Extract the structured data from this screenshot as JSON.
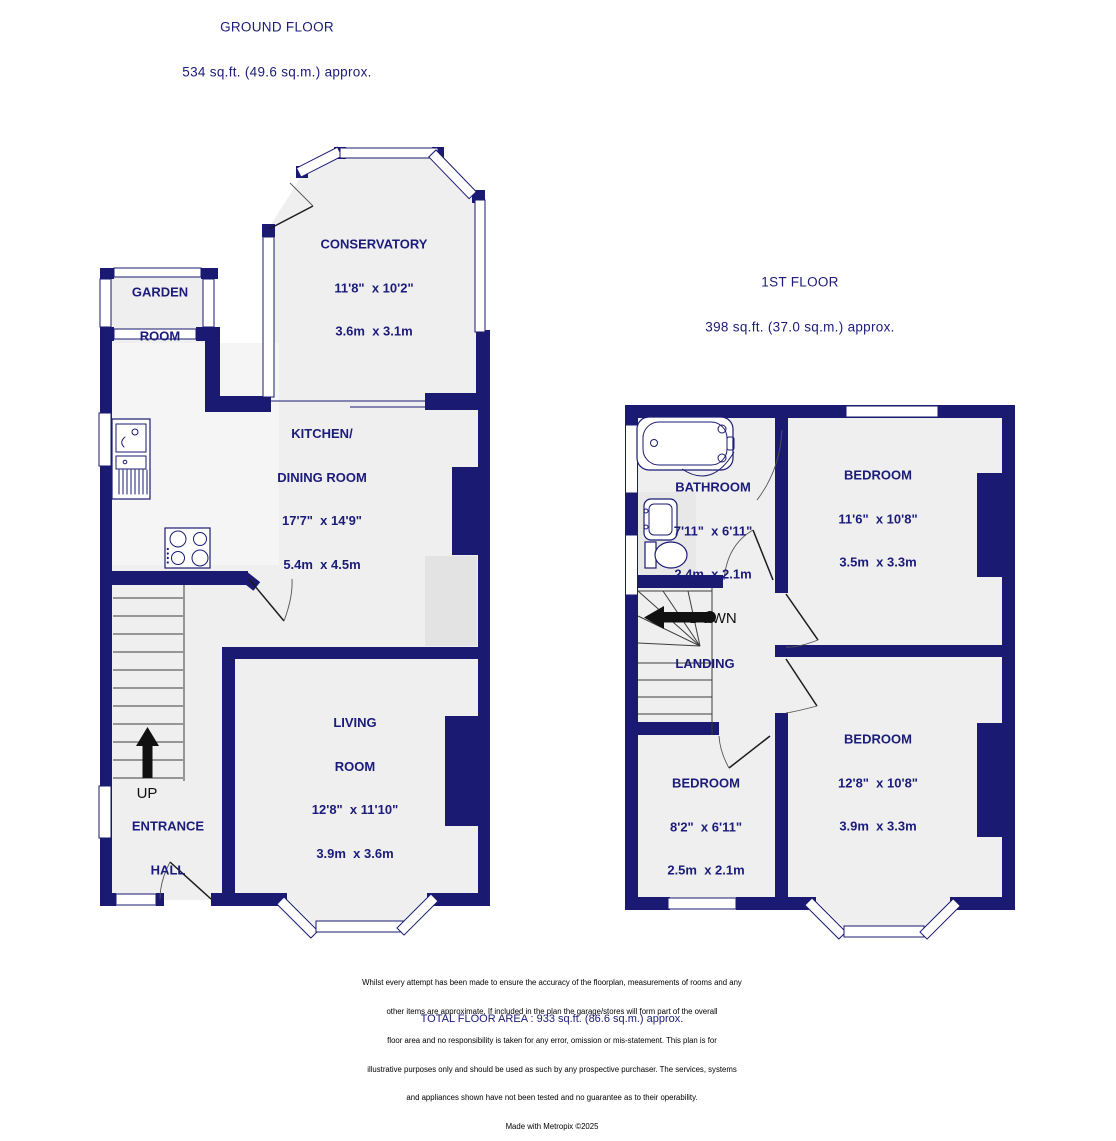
{
  "ground_title": {
    "name": "GROUND FLOOR",
    "area": "534 sq.ft. (49.6 sq.m.) approx."
  },
  "first_title": {
    "name": "1ST FLOOR",
    "area": "398 sq.ft. (37.0 sq.m.) approx."
  },
  "rooms": {
    "conservatory": {
      "name": "CONSERVATORY",
      "imperial": "11'8\"  x 10'2\"",
      "metric": "3.6m  x 3.1m"
    },
    "garden_room": {
      "name1": "GARDEN",
      "name2": "ROOM"
    },
    "kitchen": {
      "name1": "KITCHEN/",
      "name2": "DINING ROOM",
      "imperial": "17'7\"  x 14'9\"",
      "metric": "5.4m  x 4.5m"
    },
    "living_room": {
      "name1": "LIVING",
      "name2": "ROOM",
      "imperial": "12'8\"  x 11'10\"",
      "metric": "3.9m  x 3.6m"
    },
    "entrance_hall": {
      "name1": "ENTRANCE",
      "name2": "HALL"
    },
    "bathroom": {
      "name": "BATHROOM",
      "imperial": "7'11\"  x 6'11\"",
      "metric": "2.4m  x 2.1m"
    },
    "bedroom_front": {
      "name": "BEDROOM",
      "imperial": "11'6\"  x 10'8\"",
      "metric": "3.5m  x 3.3m"
    },
    "bedroom_back": {
      "name": "BEDROOM",
      "imperial": "12'8\"  x 10'8\"",
      "metric": "3.9m  x 3.3m"
    },
    "bedroom_small": {
      "name": "BEDROOM",
      "imperial": "8'2\"  x 6'11\"",
      "metric": "2.5m  x 2.1m"
    },
    "landing": {
      "name": "LANDING"
    }
  },
  "stairs": {
    "up": "UP",
    "down": "DOWN"
  },
  "footer": {
    "total": "TOTAL FLOOR AREA : 933 sq.ft. (86.6 sq.m.) approx.",
    "line1": "Whilst every attempt has been made to ensure the accuracy of the floorplan, measurements of rooms and any",
    "line2": "other items are approximate, If included in the plan the garage/stores will form part of the overall",
    "line3": "floor area and no responsibility is taken for any error, omission or mis-statement. This plan is for",
    "line4": "illustrative purposes only and should be used as such by any prospective purchaser. The services, systems",
    "line5": "and appliances shown have not been tested and no guarantee as to their operability.",
    "credit": "Made with Metropix ©2025"
  },
  "colors": {
    "wall": "#1a1a73",
    "floor": "#efefef",
    "label_text": "#1b1b7a",
    "stair_text": "#111111"
  }
}
